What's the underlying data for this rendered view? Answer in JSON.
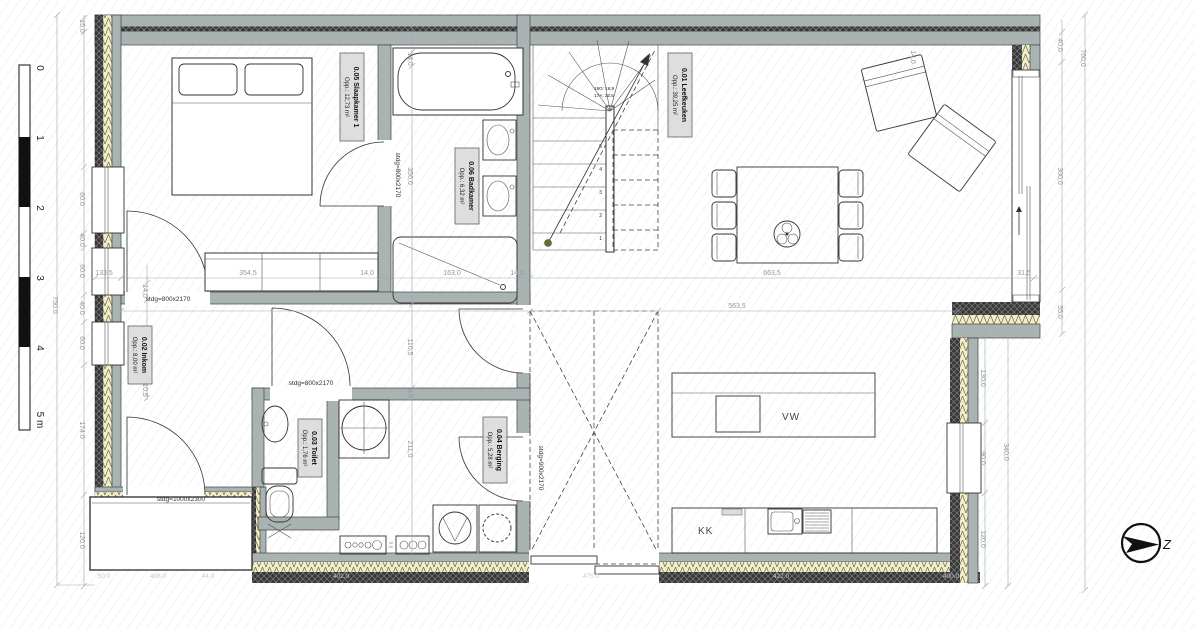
{
  "colors": {
    "wall_gray": "#a9b3b2",
    "insulation": "#f3eec6",
    "masonry": "#383838",
    "label_bg": "#dcdcdc",
    "dim_line": "#9fa9ae"
  },
  "rooms": [
    {
      "name": "0.01 Leefkeuken",
      "area": "Opp.: 39,25 m²"
    },
    {
      "name": "0.02 Inkom",
      "area": "Opp.: 8,00 m²"
    },
    {
      "name": "0.03 Toilet",
      "area": "Opp.: 1,76 m²"
    },
    {
      "name": "0.04 Berging",
      "area": "Opp.: 5,28 m²"
    },
    {
      "name": "0.05 Slaapkamer 1",
      "area": "Opp.: 12,73 m²"
    },
    {
      "name": "0.06 Badkamer",
      "area": "Opp.: 6,32 m²"
    }
  ],
  "doors": {
    "bedroom": "stdg=800x2170",
    "entry_bedroom": "stdg=800x2170",
    "hall": "stdg=800x2170",
    "berging": "stdg=900x2170",
    "front": "stdg=1000x2300"
  },
  "stairs": {
    "riser_note": "18O: 16,9",
    "tread_note": "17A: 22,5",
    "steps": [
      "1",
      "2",
      "3",
      "4",
      "5"
    ]
  },
  "kitchen": {
    "dishwasher": "VW",
    "fridge": "KK"
  },
  "compass": {
    "label": "Z"
  },
  "scale_bar": {
    "labels": [
      "0",
      "1",
      "2",
      "3",
      "4",
      "5 m"
    ]
  },
  "dims": {
    "left_total": "750.0",
    "left": [
      "15.0",
      "60.0",
      "40.0",
      "60.0",
      "40.0",
      "60.0",
      "174.0",
      "120.0"
    ],
    "row1": [
      "133,5",
      "354,5",
      "14,0",
      "163,0",
      "14,0",
      "663,5",
      "31,5"
    ],
    "row2": "563,5",
    "v_bath": [
      "14,0",
      "356,0"
    ],
    "v_door": [
      "14,0",
      "10,5"
    ],
    "v_hall": [
      "110,5",
      "9,0",
      "211,0"
    ],
    "v_top_right": "14,0",
    "right_total": "760,0",
    "right_mid": [
      "40,0",
      "300,0",
      "55,0"
    ],
    "right_inner": [
      "130,0",
      "90,0",
      "120,0"
    ],
    "right_340": "340,0",
    "bottom": [
      "50.0",
      "406.0",
      "44.0",
      "402.0",
      "475.0",
      "422.0",
      "400.0"
    ]
  }
}
